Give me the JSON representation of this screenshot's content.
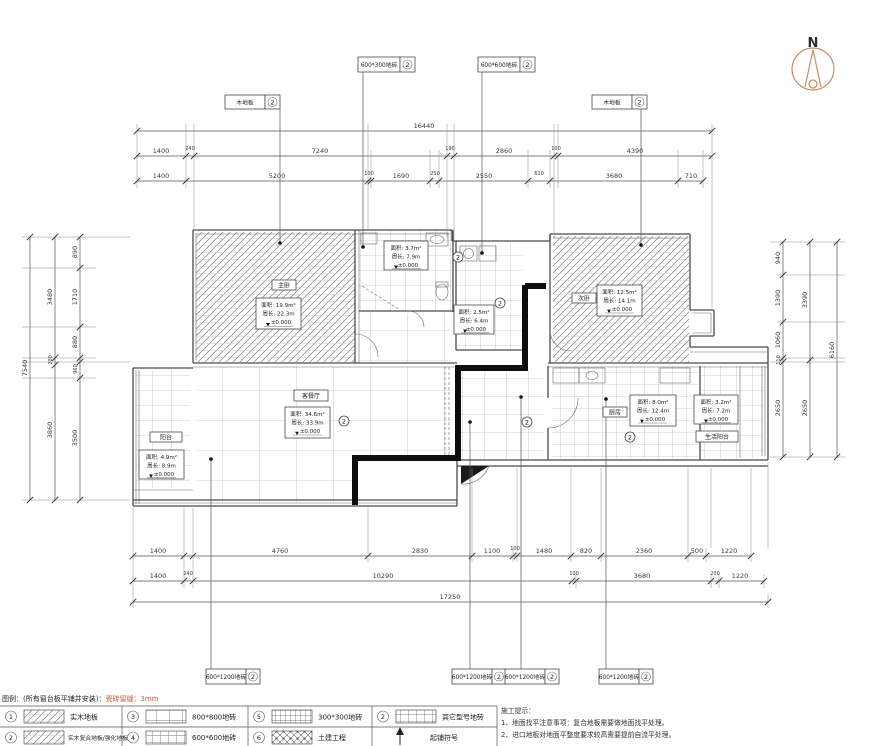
{
  "north": {
    "label": "N"
  },
  "dims": {
    "top_total": "16440",
    "top_row2": [
      "1400",
      "240",
      "7240",
      "190",
      "2860",
      "100",
      "4390"
    ],
    "top_row3": [
      "1400",
      "5200",
      "100",
      "1690",
      "250",
      "2550",
      "610",
      "3680",
      "710"
    ],
    "left_total": "7540",
    "left_mid": [
      "3480",
      "200",
      "3860"
    ],
    "left_inner": [
      "890",
      "1710",
      "880",
      "960",
      "3500"
    ],
    "right_total": "6160",
    "right_mid": [
      "3390",
      "2650"
    ],
    "right_inner": [
      "940",
      "1390",
      "1060",
      "110",
      "2650"
    ],
    "bottom_row1": [
      "1400",
      "4760",
      "2830",
      "1100",
      "100",
      "1480",
      "820",
      "2360",
      "500",
      "1220"
    ],
    "bottom_row2": [
      "1400",
      "240",
      "10290",
      "100",
      "3680",
      "200",
      "1220"
    ],
    "bottom_total": "17250"
  },
  "callouts": {
    "marker_num": "2",
    "top": [
      {
        "label": "木地板",
        "num": "2"
      },
      {
        "label": "600*300地砖",
        "num": "2"
      },
      {
        "label": "600*600地砖",
        "num": "2"
      },
      {
        "label": "木地板",
        "num": "2"
      }
    ],
    "bottom": [
      {
        "label": "600*1200地砖",
        "num": "2"
      },
      {
        "label": "600*1200地砖",
        "num": "2"
      },
      {
        "label": "600*1200地砖",
        "num": "2"
      },
      {
        "label": "600*1200地砖",
        "num": "2"
      }
    ]
  },
  "rooms": {
    "master": {
      "name": "主卧",
      "area": "面积: 19.9m²",
      "perim": "周长: 22.3m",
      "level": "±0.000"
    },
    "bath1": {
      "area": "面积: 3.7m²",
      "perim": "周长: 7.9m",
      "level": "±0.000"
    },
    "bath2": {
      "area": "面积: 2.5m²",
      "perim": "周长: 6.4m",
      "level": "±0.000"
    },
    "second": {
      "name": "次卧",
      "area": "面积: 12.5m²",
      "perim": "周长: 14.1m",
      "level": "±0.000"
    },
    "living": {
      "name": "客餐厅",
      "area": "面积: 34.6m²",
      "perim": "周长: 33.9m",
      "level": "±0.000"
    },
    "balcony": {
      "name": "阳台",
      "area": "面积: 4.9m²",
      "perim": "周长: 8.9m",
      "level": "±0.000"
    },
    "kitchen": {
      "name": "厨房",
      "area": "面积: 8.0m²",
      "perim": "周长: 12.4m",
      "level": "±0.000"
    },
    "service": {
      "name": "生活阳台",
      "area": "面积: 3.2m²",
      "perim": "周长: 7.2m",
      "level": "±0.000"
    }
  },
  "legend": {
    "title": "图例：(所有窗台板平铺并安装)：",
    "title_red": "瓷砖留缝：3mm",
    "row1": [
      {
        "num": "1",
        "label": "实木地板"
      },
      {
        "num": "3",
        "label": "800*800地砖"
      },
      {
        "num": "5",
        "label": "300*300地砖"
      },
      {
        "num": "2",
        "label": "其它型号地砖"
      }
    ],
    "row2": [
      {
        "num": "2",
        "label": "实木复合地板/强化地板"
      },
      {
        "num": "4",
        "label": "600*600地砖"
      },
      {
        "num": "6",
        "label": "土建工程"
      },
      {
        "num": "",
        "label": "起铺符号"
      }
    ]
  },
  "notes": {
    "title": "施工提示：",
    "line1": "1、地面找平注意事项：复合地板需要做地面找平处理。",
    "line2": "2、进口地板对地面平整度要求较高需要提前自流平处理。"
  }
}
